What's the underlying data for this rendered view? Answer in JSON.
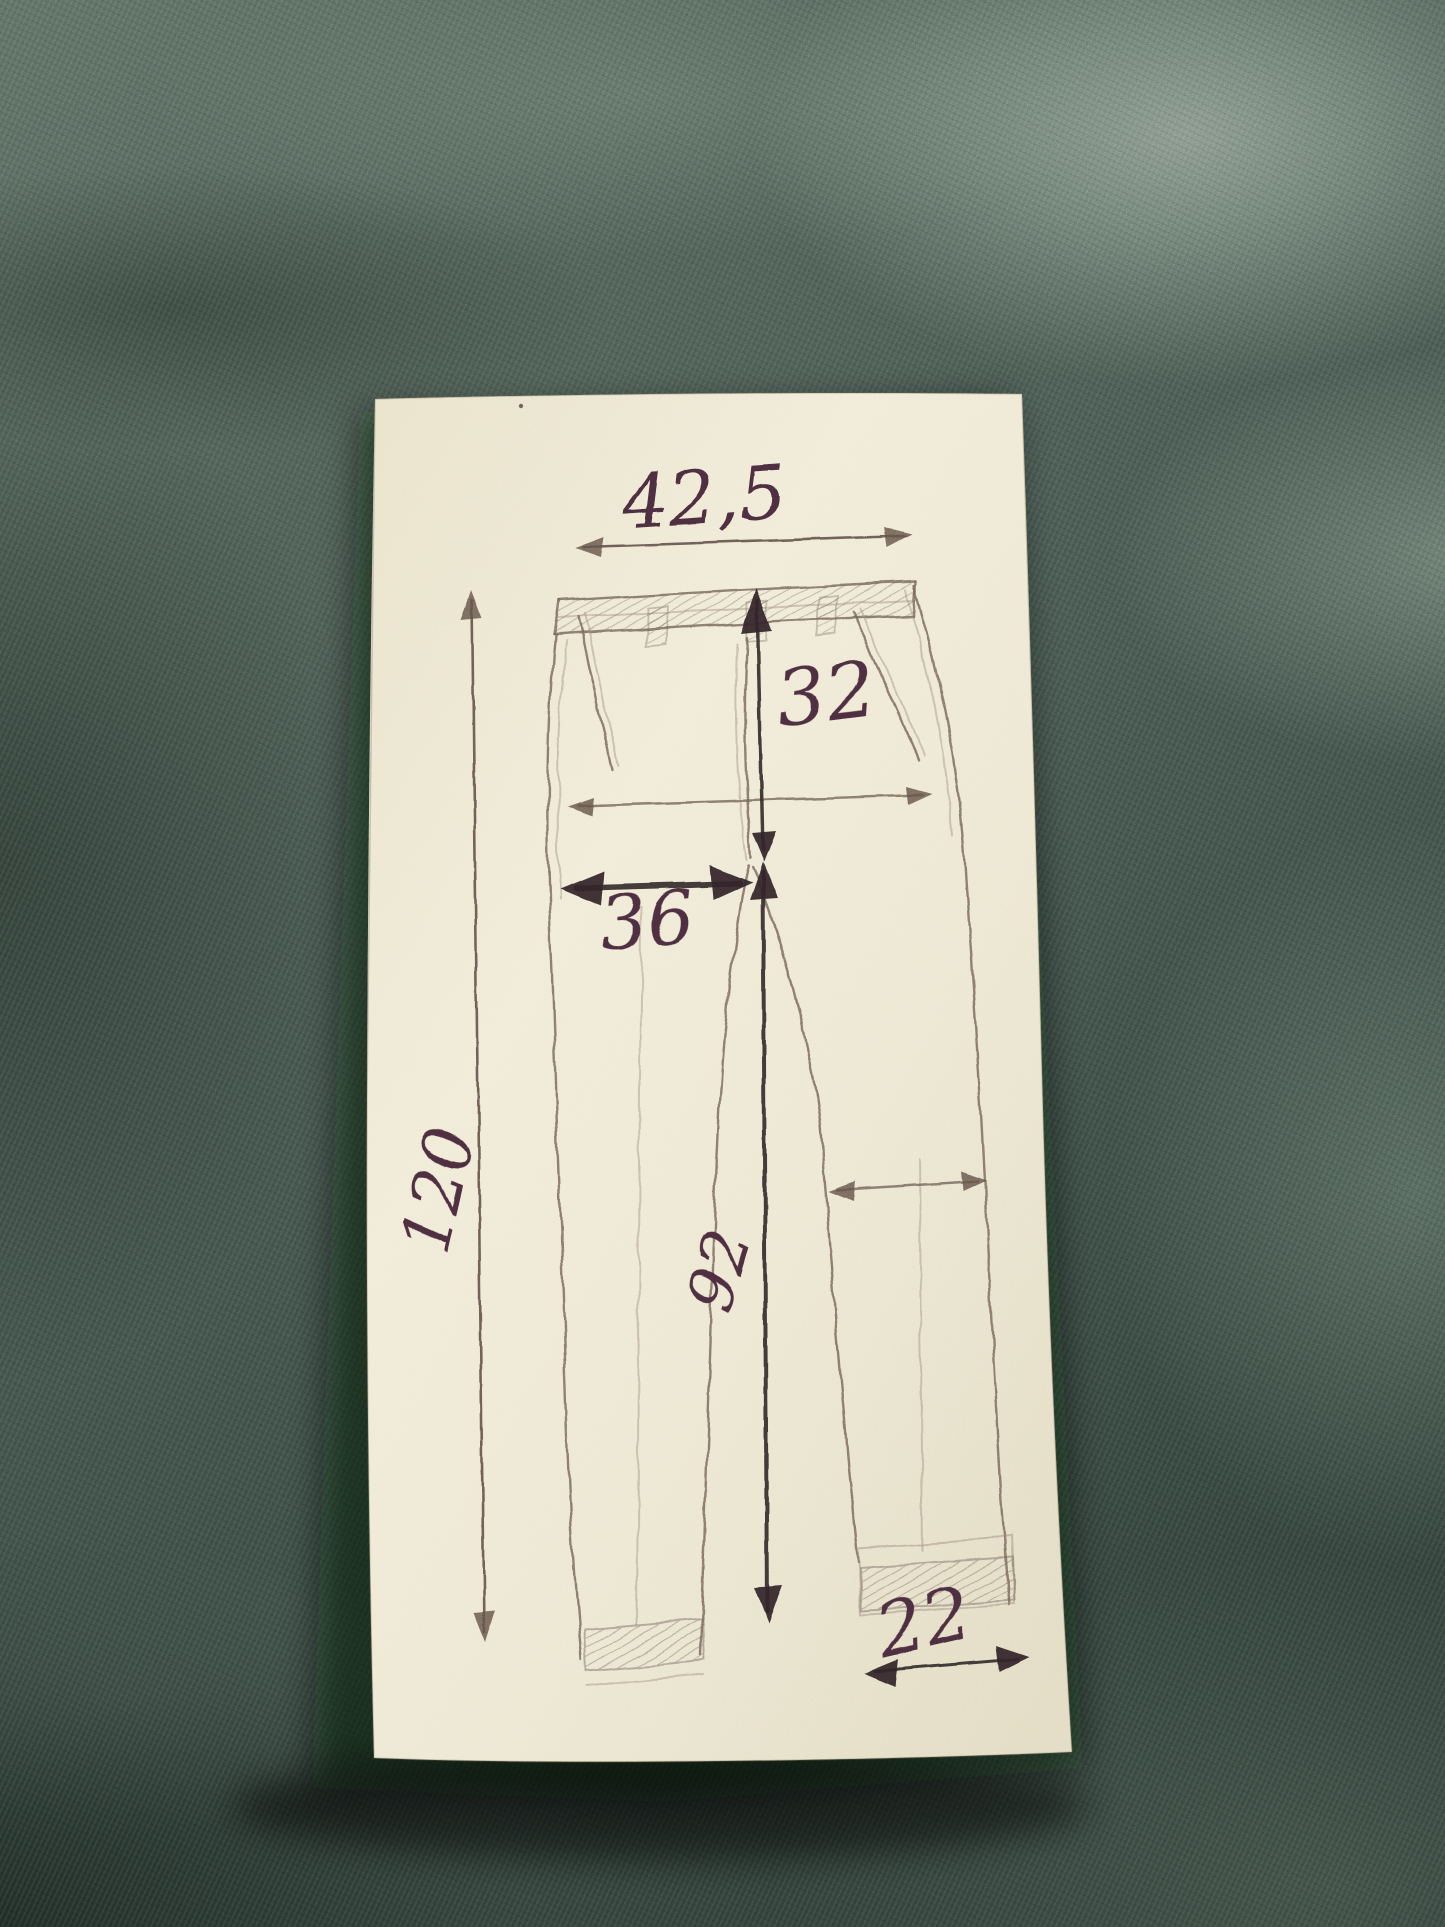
{
  "photo": {
    "subject": "hand-drawn trouser measurement sketch on cream paper lying on green knit fabric",
    "paper_color": "#ece6cf",
    "fabric_color": "#44544b",
    "ink_color": "#472b3a",
    "pencil_color": "#6e5f53"
  },
  "measurements": {
    "waist_width": {
      "value": "42,5",
      "orientation": "horizontal",
      "location": "top waistband"
    },
    "front_rise": {
      "value": "32",
      "orientation": "vertical",
      "location": "waistband to crotch"
    },
    "thigh_width": {
      "value": "36",
      "orientation": "horizontal",
      "location": "left leg at crotch level"
    },
    "total_length": {
      "value": "120",
      "orientation": "vertical",
      "location": "full length along left side"
    },
    "inseam_length": {
      "value": "92",
      "orientation": "vertical",
      "location": "crotch to hem between legs"
    },
    "leg_opening": {
      "value": "22",
      "orientation": "horizontal",
      "location": "right leg hem"
    }
  },
  "unlabeled_arrows": [
    {
      "name": "hip-width-arrow",
      "orientation": "horizontal",
      "location": "hip line across trousers"
    },
    {
      "name": "knee-width-arrow",
      "orientation": "horizontal",
      "location": "right leg at knee"
    }
  ]
}
